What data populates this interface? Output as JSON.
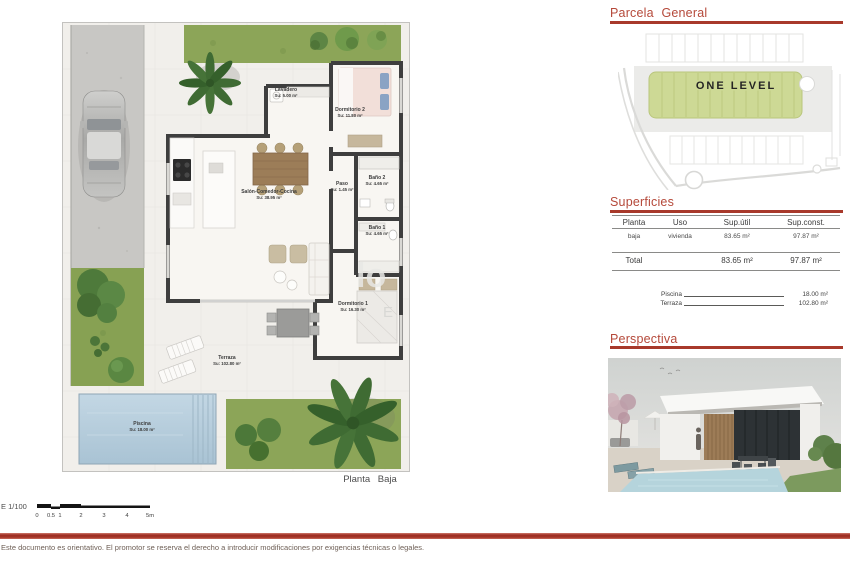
{
  "page": {
    "footer_disclaimer": "Este documento es orientativo. El promotor se reserva el derecho a introducir modificaciones por exigencias técnicas o legales.",
    "scale": {
      "label": "E 1/100",
      "ticks": [
        "0",
        "0.5",
        "1",
        "2",
        "3",
        "4",
        "5m"
      ]
    }
  },
  "floor_plan": {
    "caption": "Planta Baja",
    "watermark": {
      "part1": "lo",
      "part2": "E"
    },
    "rooms": [
      {
        "name": "Lavadero",
        "area": "Su: 5.00 m²"
      },
      {
        "name": "Dormitorio 2",
        "area": "Su: 11.80 m²"
      },
      {
        "name": "Salón-Comedor-Cocina",
        "area": "Su: 38.95 m²"
      },
      {
        "name": "Paso",
        "area": "Su: 1.45 m²"
      },
      {
        "name": "Baño 2",
        "area": "Su: 4.65 m²"
      },
      {
        "name": "Baño 1",
        "area": "Su: 4.65 m²"
      },
      {
        "name": "Dormitorio 1",
        "area": "Su: 16.30 m²"
      },
      {
        "name": "Terraza",
        "area": "Su: 102.80 m²"
      },
      {
        "name": "Piscina",
        "area": "Su: 18.00 m²"
      }
    ]
  },
  "parcela": {
    "title": "Parcela General",
    "plot_label": "ONE LEVEL"
  },
  "superficies": {
    "title": "Superficies",
    "headers": [
      "Planta",
      "Uso",
      "Sup.útil",
      "Sup.const."
    ],
    "rows": [
      [
        "baja",
        "vivienda",
        "83.65 m²",
        "97.87 m²"
      ]
    ],
    "total": [
      "Total",
      "83.65 m²",
      "97.87 m²"
    ],
    "extras": [
      {
        "label": "Piscina",
        "value": "18.00 m²"
      },
      {
        "label": "Terraza",
        "value": "102.80 m²"
      }
    ]
  },
  "perspectiva": {
    "title": "Perspectiva"
  },
  "colors": {
    "accent_red": "#b5493a",
    "rule_red": "#a8392b",
    "wall_dark": "#3e3e3e",
    "grass_green": "#8ba557",
    "pool_blue": "#b7cede",
    "parcel_green": "#cdd995"
  }
}
